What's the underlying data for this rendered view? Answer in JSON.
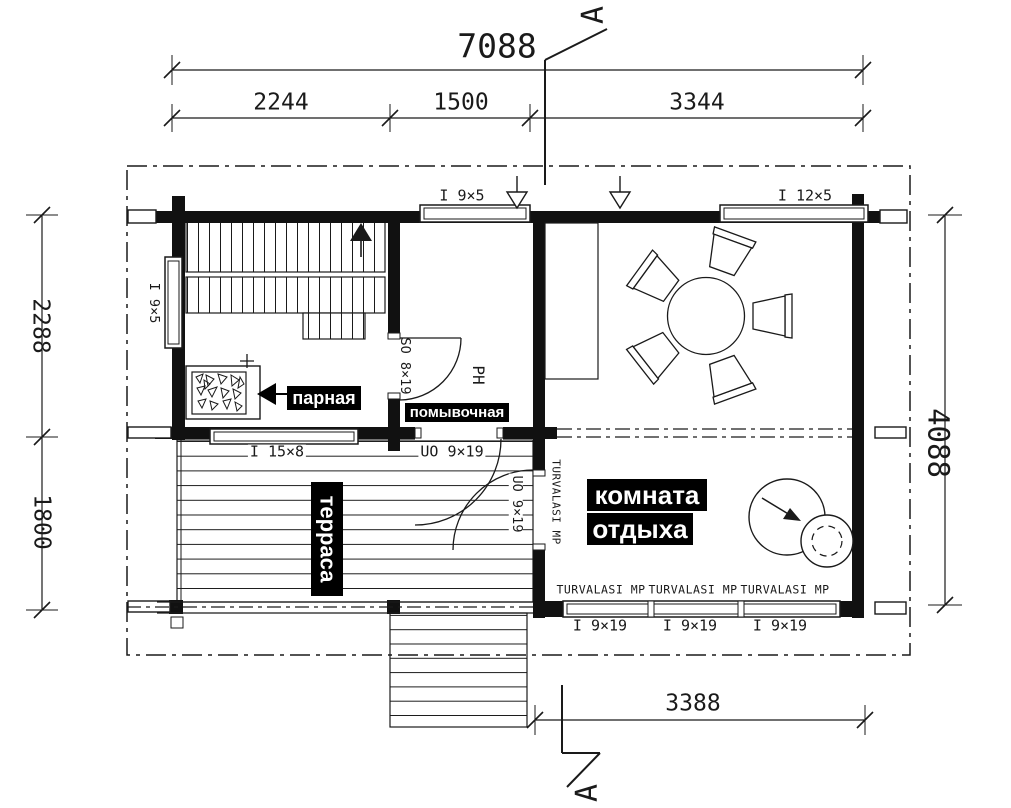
{
  "section": {
    "label": "А"
  },
  "dims": {
    "total": "7088",
    "seg1": "2244",
    "seg2": "1500",
    "seg3": "3344",
    "left_upper": "2288",
    "left_lower": "1800",
    "right": "4088",
    "bottom": "3388"
  },
  "rooms": {
    "sauna": "парная",
    "wash": "помывочная",
    "terrace": "терраса",
    "lounge1": "комната",
    "lounge2": "отдыха"
  },
  "openings": {
    "top_win_small": "I 9×5",
    "top_win_large": "I 12×5",
    "left_win": "I 9×5",
    "sauna_win": "I 15×8",
    "terrace_door": "UO 9×19",
    "lounge_door": "UO 9×19",
    "sauna_door": "SO 8×19",
    "wash_mark": "PH",
    "bottom_win": "I 9×19",
    "glass": "TURVALASI MP"
  },
  "colors": {
    "ink": "#1a1a1a",
    "label_bg": "#000000",
    "label_fg": "#ffffff",
    "paper": "#ffffff"
  }
}
